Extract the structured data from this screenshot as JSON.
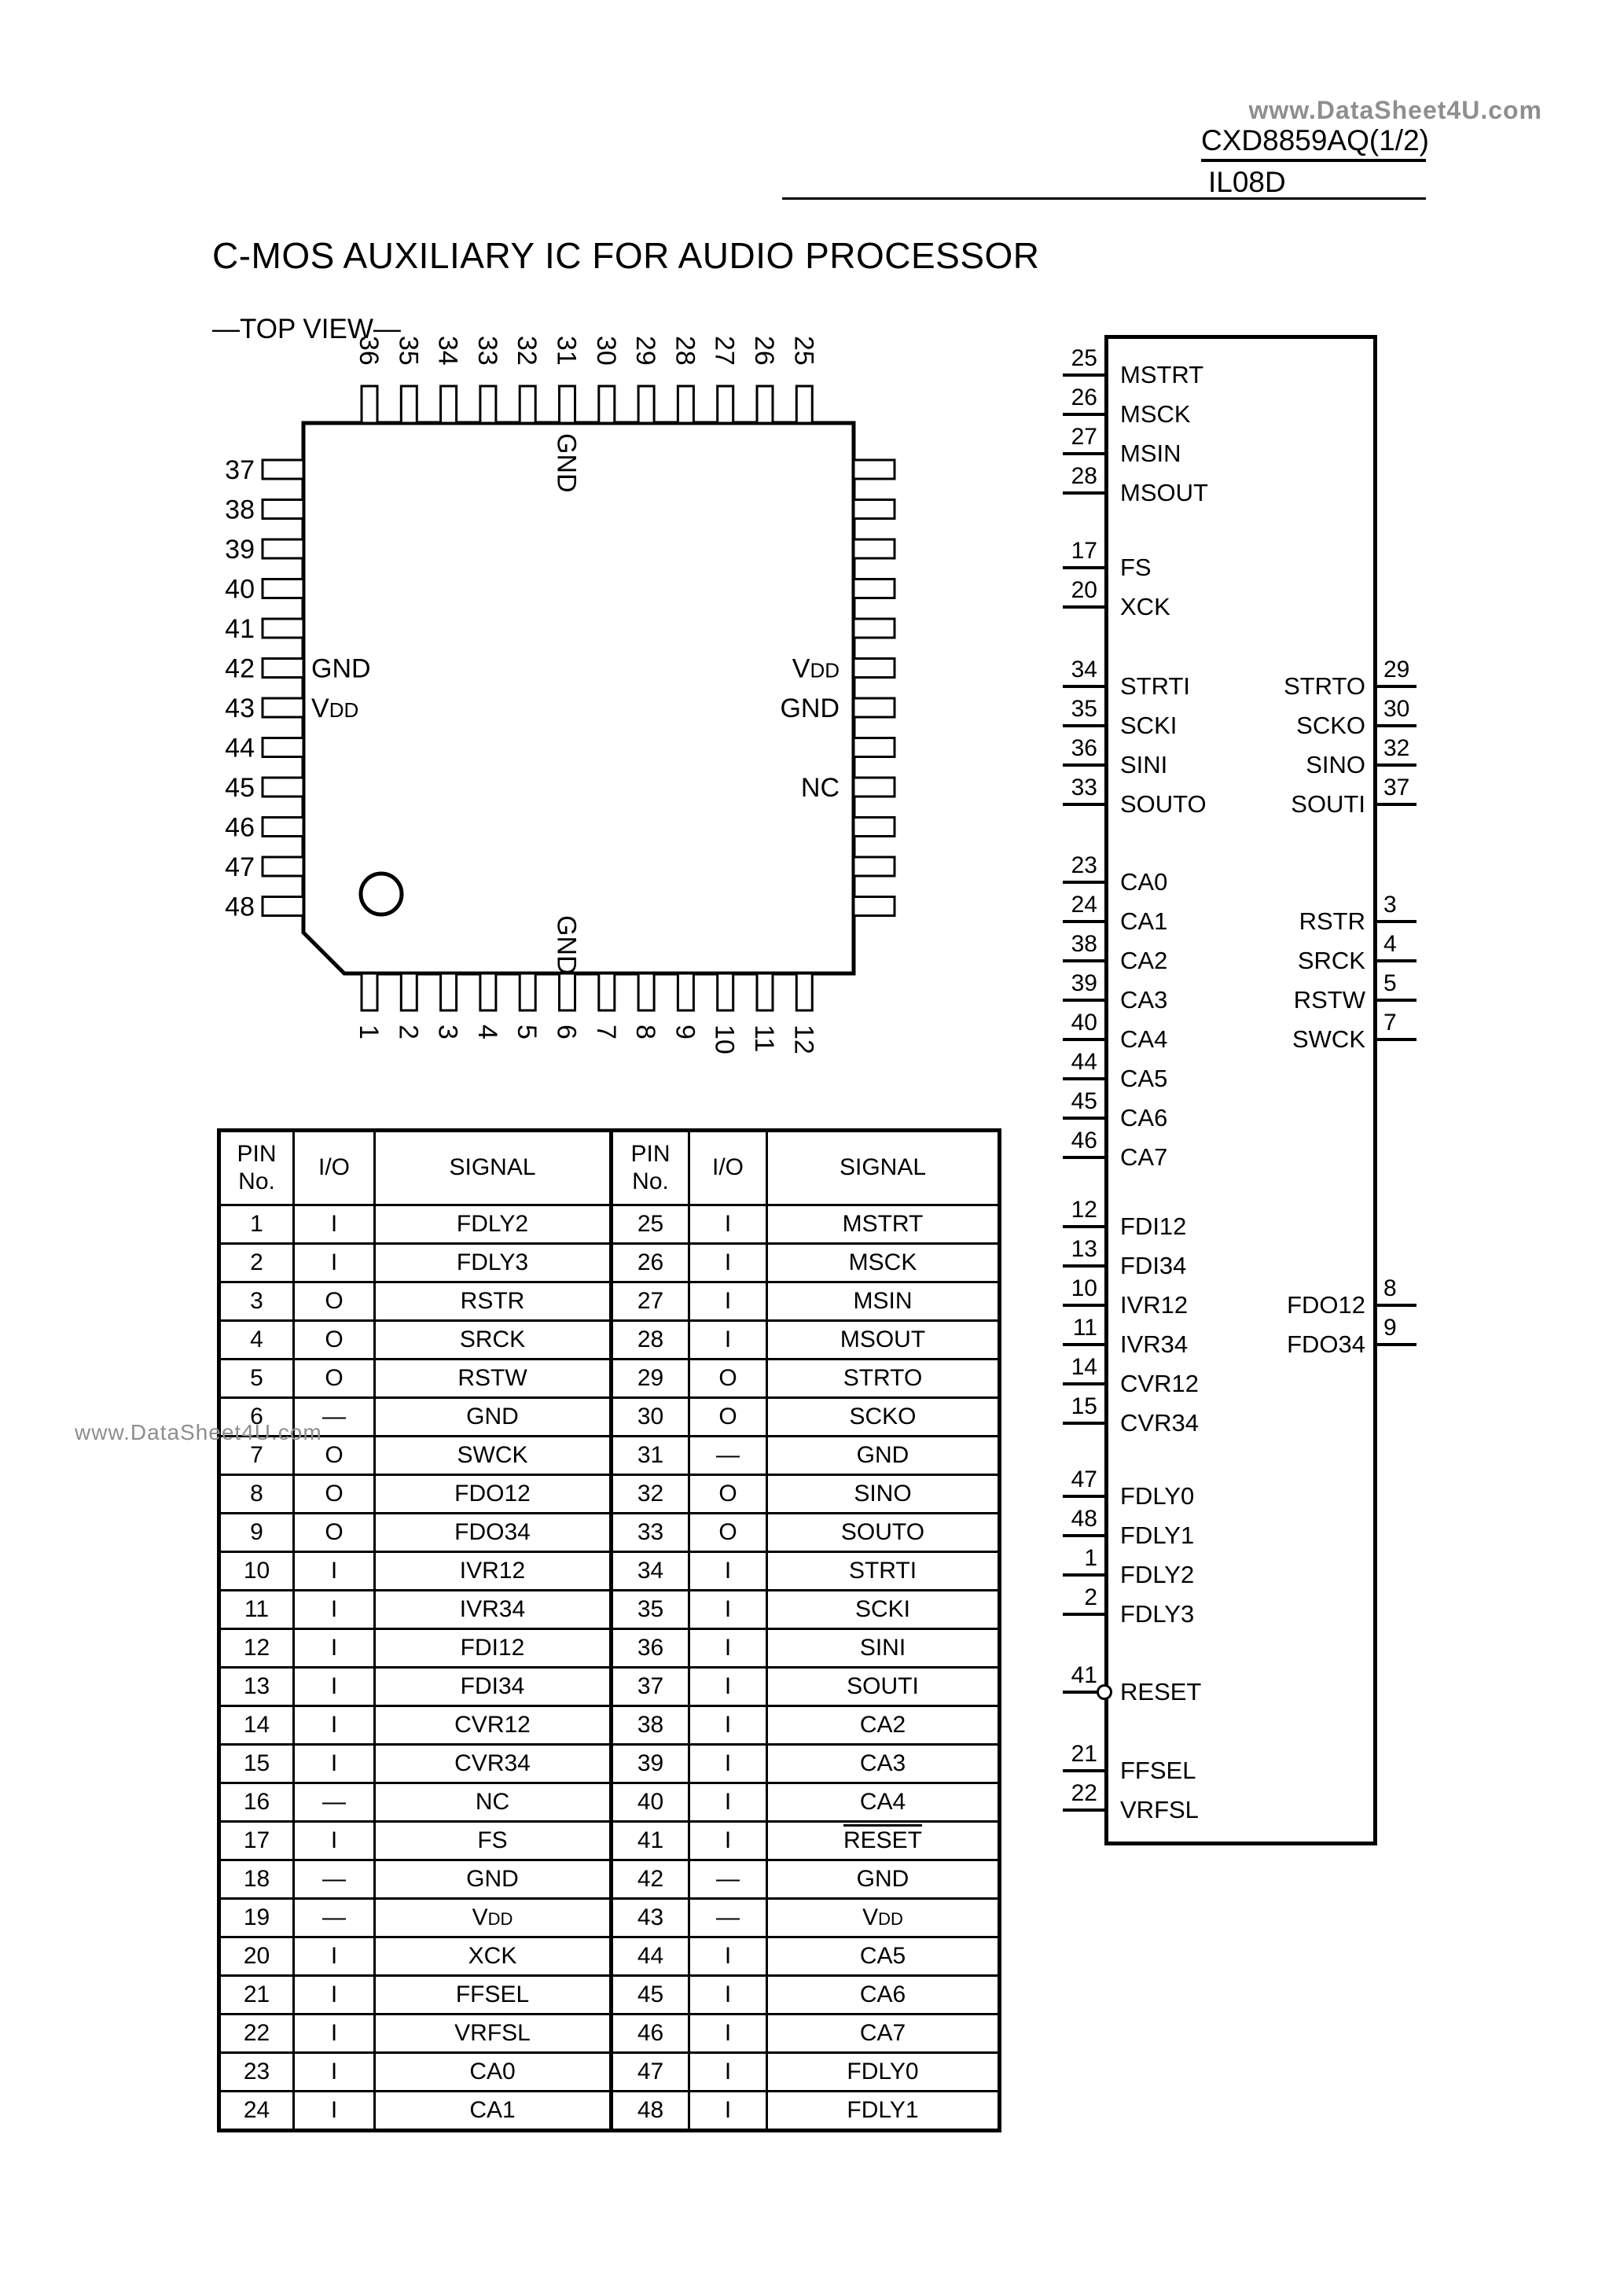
{
  "header": {
    "watermark": "www.DataSheet4U.com",
    "part_number": "CXD8859AQ(1/2)",
    "doc_code": "IL08D"
  },
  "title": "C-MOS AUXILIARY IC FOR AUDIO PROCESSOR",
  "subtitle": "—TOP VIEW—",
  "side_watermark": "www.DataSheet4U.com",
  "chip": {
    "top_pins": [
      "36",
      "35",
      "34",
      "33",
      "32",
      "31",
      "30",
      "29",
      "28",
      "27",
      "26",
      "25"
    ],
    "bottom_pins": [
      "1",
      "2",
      "3",
      "4",
      "5",
      "6",
      "7",
      "8",
      "9",
      "10",
      "11",
      "12"
    ],
    "left_pins": [
      "37",
      "38",
      "39",
      "40",
      "41",
      "42",
      "43",
      "44",
      "45",
      "46",
      "47",
      "48"
    ],
    "right_pins": [
      "24",
      "23",
      "22",
      "21",
      "20",
      "19",
      "18",
      "17",
      "16",
      "15",
      "14",
      "13"
    ],
    "inner_labels": {
      "top": "GND",
      "bottom": "GND",
      "left": [
        {
          "pin": "42",
          "label": "GND"
        },
        {
          "pin": "43",
          "label": "VDD"
        }
      ],
      "right": [
        {
          "pin": "19",
          "label": "VDD"
        },
        {
          "pin": "18",
          "label": "GND"
        },
        {
          "pin": "16",
          "label": "NC"
        }
      ]
    }
  },
  "block_diagram": {
    "left_stubs": [
      {
        "pin": "25",
        "label": "MSTRT"
      },
      {
        "pin": "26",
        "label": "MSCK"
      },
      {
        "pin": "27",
        "label": "MSIN"
      },
      {
        "pin": "28",
        "label": "MSOUT"
      },
      {
        "pin": "17",
        "label": "FS"
      },
      {
        "pin": "20",
        "label": "XCK"
      },
      {
        "pin": "34",
        "label": "STRTI"
      },
      {
        "pin": "35",
        "label": "SCKI"
      },
      {
        "pin": "36",
        "label": "SINI"
      },
      {
        "pin": "33",
        "label": "SOUTO"
      },
      {
        "pin": "23",
        "label": "CA0"
      },
      {
        "pin": "24",
        "label": "CA1"
      },
      {
        "pin": "38",
        "label": "CA2"
      },
      {
        "pin": "39",
        "label": "CA3"
      },
      {
        "pin": "40",
        "label": "CA4"
      },
      {
        "pin": "44",
        "label": "CA5"
      },
      {
        "pin": "45",
        "label": "CA6"
      },
      {
        "pin": "46",
        "label": "CA7"
      },
      {
        "pin": "12",
        "label": "FDI12"
      },
      {
        "pin": "13",
        "label": "FDI34"
      },
      {
        "pin": "10",
        "label": "IVR12"
      },
      {
        "pin": "11",
        "label": "IVR34"
      },
      {
        "pin": "14",
        "label": "CVR12"
      },
      {
        "pin": "15",
        "label": "CVR34"
      },
      {
        "pin": "47",
        "label": "FDLY0"
      },
      {
        "pin": "48",
        "label": "FDLY1"
      },
      {
        "pin": "1",
        "label": "FDLY2"
      },
      {
        "pin": "2",
        "label": "FDLY3"
      },
      {
        "pin": "41",
        "label": "RESET",
        "bubble": true
      },
      {
        "pin": "21",
        "label": "FFSEL"
      },
      {
        "pin": "22",
        "label": "VRFSL"
      }
    ],
    "right_stubs": [
      {
        "pin": "29",
        "label": "STRTO"
      },
      {
        "pin": "30",
        "label": "SCKO"
      },
      {
        "pin": "32",
        "label": "SINO"
      },
      {
        "pin": "37",
        "label": "SOUTI"
      },
      {
        "pin": "3",
        "label": "RSTR"
      },
      {
        "pin": "4",
        "label": "SRCK"
      },
      {
        "pin": "5",
        "label": "RSTW"
      },
      {
        "pin": "7",
        "label": "SWCK"
      },
      {
        "pin": "8",
        "label": "FDO12"
      },
      {
        "pin": "9",
        "label": "FDO34"
      }
    ]
  },
  "pin_table": {
    "headers": [
      "PIN\nNo.",
      "I/O",
      "SIGNAL",
      "PIN\nNo.",
      "I/O",
      "SIGNAL"
    ],
    "rows_left": [
      [
        "1",
        "I",
        "FDLY2"
      ],
      [
        "2",
        "I",
        "FDLY3"
      ],
      [
        "3",
        "O",
        "RSTR"
      ],
      [
        "4",
        "O",
        "SRCK"
      ],
      [
        "5",
        "O",
        "RSTW"
      ],
      [
        "6",
        "—",
        "GND"
      ],
      [
        "7",
        "O",
        "SWCK"
      ],
      [
        "8",
        "O",
        "FDO12"
      ],
      [
        "9",
        "O",
        "FDO34"
      ],
      [
        "10",
        "I",
        "IVR12"
      ],
      [
        "11",
        "I",
        "IVR34"
      ],
      [
        "12",
        "I",
        "FDI12"
      ],
      [
        "13",
        "I",
        "FDI34"
      ],
      [
        "14",
        "I",
        "CVR12"
      ],
      [
        "15",
        "I",
        "CVR34"
      ],
      [
        "16",
        "—",
        "NC"
      ],
      [
        "17",
        "I",
        "FS"
      ],
      [
        "18",
        "—",
        "GND"
      ],
      [
        "19",
        "—",
        "VDD"
      ],
      [
        "20",
        "I",
        "XCK"
      ],
      [
        "21",
        "I",
        "FFSEL"
      ],
      [
        "22",
        "I",
        "VRFSL"
      ],
      [
        "23",
        "I",
        "CA0"
      ],
      [
        "24",
        "I",
        "CA1"
      ]
    ],
    "rows_right": [
      [
        "25",
        "I",
        "MSTRT"
      ],
      [
        "26",
        "I",
        "MSCK"
      ],
      [
        "27",
        "I",
        "MSIN"
      ],
      [
        "28",
        "I",
        "MSOUT"
      ],
      [
        "29",
        "O",
        "STRTO"
      ],
      [
        "30",
        "O",
        "SCKO"
      ],
      [
        "31",
        "—",
        "GND"
      ],
      [
        "32",
        "O",
        "SINO"
      ],
      [
        "33",
        "O",
        "SOUTO"
      ],
      [
        "34",
        "I",
        "STRTI"
      ],
      [
        "35",
        "I",
        "SCKI"
      ],
      [
        "36",
        "I",
        "SINI"
      ],
      [
        "37",
        "I",
        "SOUTI"
      ],
      [
        "38",
        "I",
        "CA2"
      ],
      [
        "39",
        "I",
        "CA3"
      ],
      [
        "40",
        "I",
        "CA4"
      ],
      [
        "41",
        "I",
        "RESET"
      ],
      [
        "42",
        "—",
        "GND"
      ],
      [
        "43",
        "—",
        "VDD"
      ],
      [
        "44",
        "I",
        "CA5"
      ],
      [
        "45",
        "I",
        "CA6"
      ],
      [
        "46",
        "I",
        "CA7"
      ],
      [
        "47",
        "I",
        "FDLY0"
      ],
      [
        "48",
        "I",
        "FDLY1"
      ]
    ],
    "overline_pins": [
      "41"
    ],
    "vdd_text": "VDD"
  }
}
